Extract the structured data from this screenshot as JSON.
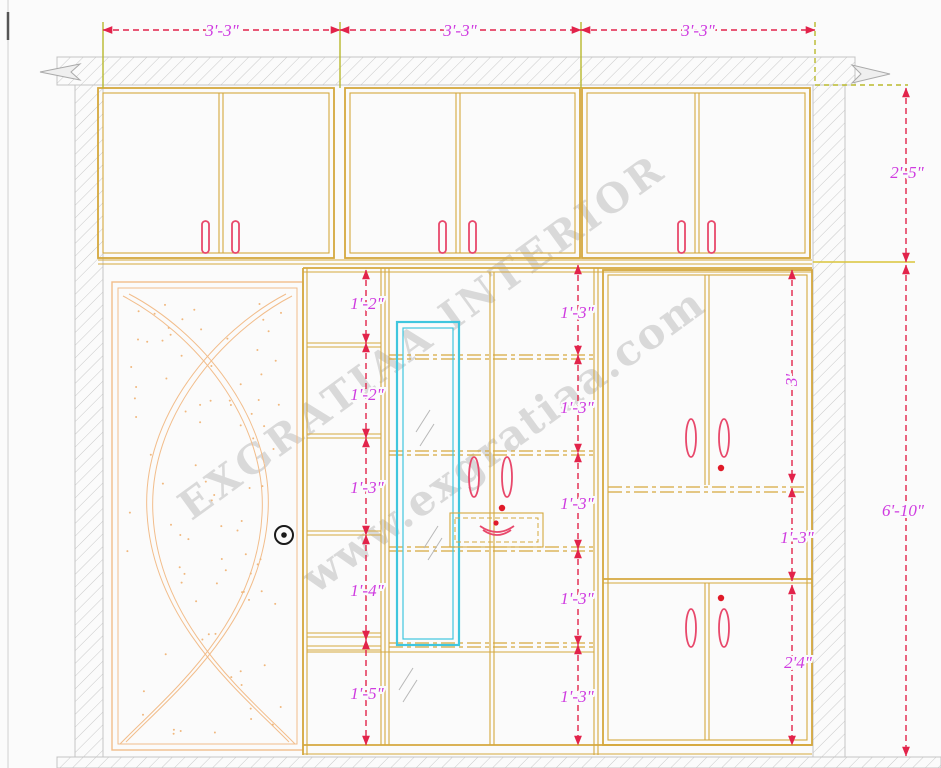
{
  "drawing": {
    "title": "wardrobe-interior-elevation",
    "watermark_line1": "EXGRATIAA INTERIOR",
    "watermark_line2": "www.exgratiaa.com",
    "dims_top": [
      "3'-3\"",
      "3'-3\"",
      "3'-3\""
    ],
    "dim_right_upper": "2'-5\"",
    "dim_right_total": "6'-10\"",
    "dims_left_shelf": [
      "1'-2\"",
      "1'-2\"",
      "1'-3\"",
      "1'-4\"",
      "1'-5\""
    ],
    "dims_center_shelf": [
      "1'-3\"",
      "1'-3\"",
      "1'-3\"",
      "1'-3\"",
      "1'-3\""
    ],
    "dims_right_cabinet": [
      "3'",
      "1'-3\"",
      "2'4\""
    ],
    "colors": {
      "cabinet_line": "#d5a83e",
      "door_line": "#f2bd8b",
      "dimension_line": "#e2234a",
      "dimension_text": "#cf3be0",
      "extension_line": "#b9b92c",
      "mirror": "#3fc6de",
      "handle": "#e8486b",
      "hatch": "#c9c9c9",
      "watermark": "#a8a8a8"
    }
  }
}
